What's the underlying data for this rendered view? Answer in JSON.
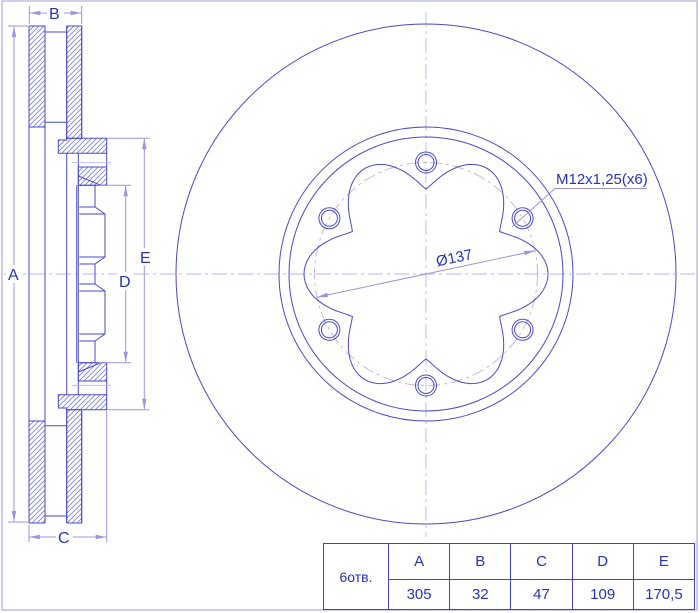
{
  "drawing": {
    "dim_labels": {
      "a": "A",
      "b": "B",
      "c": "C",
      "d": "D",
      "e": "E"
    },
    "annotations": {
      "thread_callout": "M12x1,25(x6)",
      "bolt_circle_diameter": "Ø137"
    }
  },
  "spec_table": {
    "row_label": "6отв.",
    "columns": [
      "A",
      "B",
      "C",
      "D",
      "E"
    ],
    "values": [
      "305",
      "32",
      "47",
      "109",
      "170,5"
    ]
  },
  "colors": {
    "line_main": "#4a4ac8",
    "line_dim": "#a093e0",
    "line_center": "#b9b5f0",
    "line_bolt_circle": "#c9aede",
    "hatch": "#7b7bd6",
    "text": "#2733b4",
    "table_border": "#4343bb"
  }
}
